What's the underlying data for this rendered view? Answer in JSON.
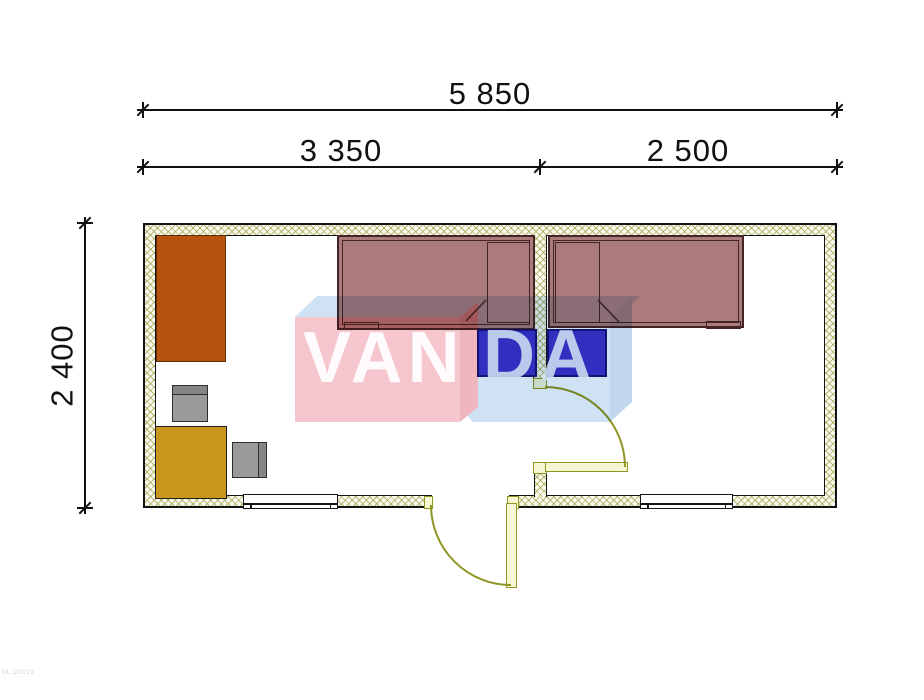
{
  "drawing": {
    "type": "floor-plan",
    "rooms": 2
  },
  "dimensions": {
    "overall_width": "5 850",
    "left_section_width": "3 350",
    "right_section_width": "2 500",
    "depth": "2 400"
  },
  "watermark": {
    "text_left": "VAN",
    "text_right": "DA"
  },
  "corner_code": "DL.102/23",
  "colors": {
    "wall_fill": "#fbfaee",
    "wall_hatch": "#a3a350",
    "wall_line": "#141414",
    "door_line": "#8f9623",
    "door_fill": "#f6f6d2",
    "bed": "#ab7b7b",
    "bed_line": "#432525",
    "nightstand": "#3c35c8",
    "wardrobe": "#b5530f",
    "table": "#c8961c",
    "chair": "#9a9a9a",
    "dim_text": "#111111",
    "wm_pink": "#f6c6ce",
    "wm_pink_side": "#f0b6c0",
    "wm_blue": "#cfe2f4",
    "wm_blue_side": "#c2d8ee"
  }
}
